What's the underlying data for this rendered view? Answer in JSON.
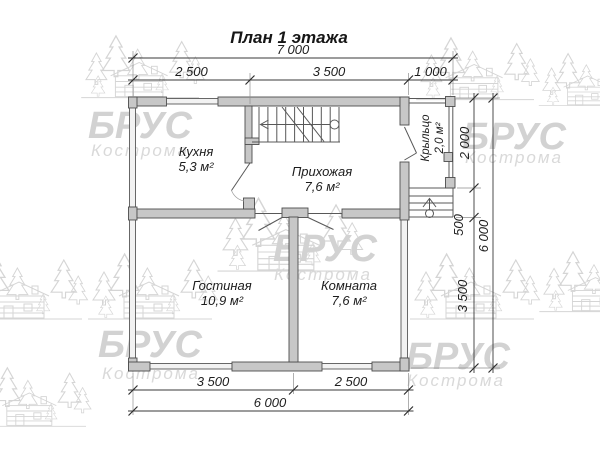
{
  "title": "План 1 этажа",
  "watermark": {
    "brand": "БРУС",
    "city": "Кострома"
  },
  "rooms": {
    "kitchen": {
      "name": "Кухня",
      "area": "5,3 м²"
    },
    "hallway": {
      "name": "Прихожая",
      "area": "7,6 м²"
    },
    "living": {
      "name": "Гостиная",
      "area": "10,9 м²"
    },
    "bedroom": {
      "name": "Комната",
      "area": "7,6 м²"
    },
    "porch": {
      "name": "Крыльцо",
      "area": "2,0 м²"
    }
  },
  "dimensions": {
    "top": {
      "total": "7 000",
      "seg1": "2 500",
      "seg2": "3 500",
      "seg3": "1 000"
    },
    "bottom": {
      "total": "6 000",
      "seg1": "3 500",
      "seg2": "2 500"
    },
    "right": {
      "total": "6 000",
      "seg1": "2 000",
      "seg2": "500",
      "seg3": "3 500"
    }
  },
  "colors": {
    "wall_fill": "#c7c7c7",
    "wall_stroke": "#4c4c4c",
    "watermark": "#d2d2d2",
    "text": "#1c1c1c"
  }
}
